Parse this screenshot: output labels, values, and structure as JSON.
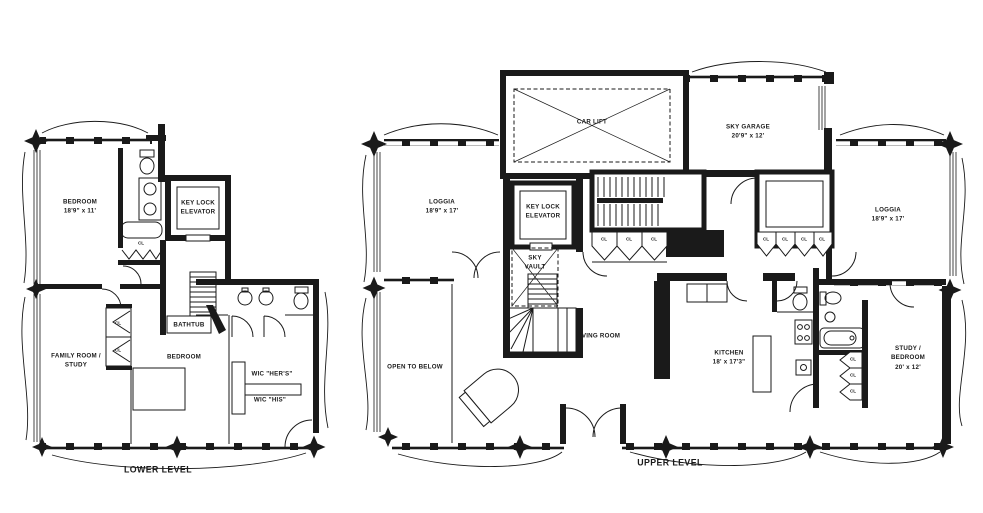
{
  "document": {
    "background": "#ffffff",
    "ink": "#1a1a1a"
  },
  "lower_level": {
    "title": "LOWER LEVEL",
    "labels": {
      "bedroom1_name": "BEDROOM",
      "bedroom1_dims": "18'9\" x 11'",
      "elevator_line1": "KEY LOCK",
      "elevator_line2": "ELEVATOR",
      "closet_bath": "CL",
      "family_line1": "FAMILY ROOM /",
      "family_line2": "STUDY",
      "closet_1": "CL",
      "closet_2": "CL",
      "bathtub": "BATHTUB",
      "bedroom2_name": "BEDROOM",
      "wic_hers": "WIC \"HER'S\"",
      "wic_his": "WIC \"HIS\""
    }
  },
  "upper_level": {
    "title": "UPPER LEVEL",
    "labels": {
      "car_lift": "CAR LIFT",
      "sky_garage_name": "SKY GARAGE",
      "sky_garage_dims": "20'9\" x 12'",
      "loggia_left_name": "LOGGIA",
      "loggia_left_dims": "18'9\" x 17'",
      "elevator_line1": "KEY LOCK",
      "elevator_line2": "ELEVATOR",
      "sky_vault_line1": "SKY",
      "sky_vault_line2": "VAULT",
      "stair_closets": [
        "CL",
        "CL",
        "CL"
      ],
      "hall_closets": [
        "CL",
        "CL",
        "CL",
        "CL"
      ],
      "open_to_below": "OPEN TO BELOW",
      "living_room": "LIVING ROOM",
      "kitchen_name": "KITCHEN",
      "kitchen_dims": "18' x 17'3\"",
      "loggia_right_name": "LOGGIA",
      "loggia_right_dims": "18'9\" x 17'",
      "study_line1": "STUDY /",
      "study_line2": "BEDROOM",
      "study_dims": "20' x 12'",
      "bath_closets": [
        "CL",
        "CL",
        "CL"
      ]
    }
  }
}
